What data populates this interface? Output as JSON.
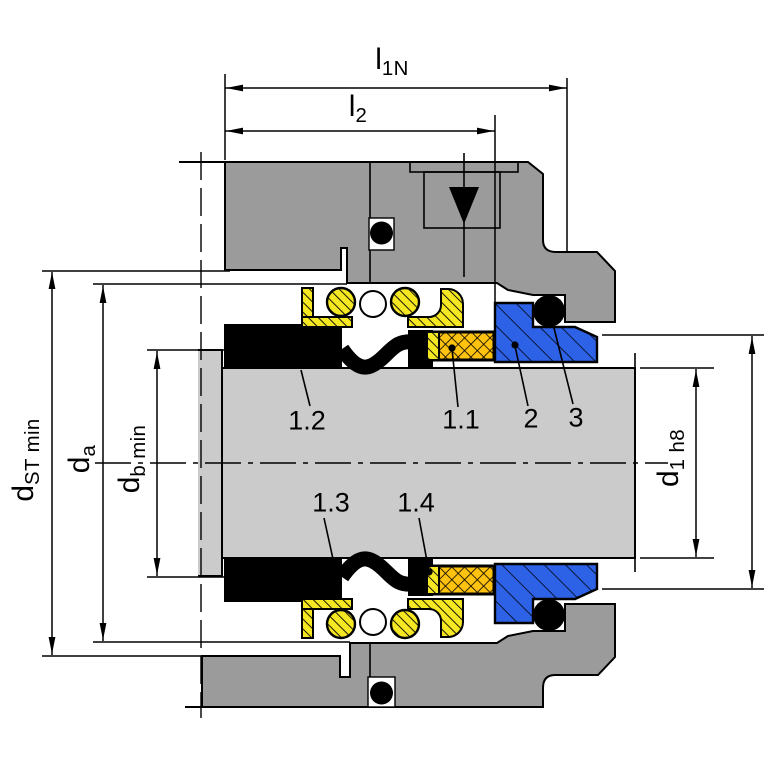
{
  "drawing": {
    "title": "mechanical-seal-cross-section",
    "dimensions": {
      "l1n": {
        "main": "l",
        "sub": "1N"
      },
      "l2": {
        "main": "l",
        "sub": "2"
      },
      "d_st_min": {
        "main": "d",
        "sub": "ST min"
      },
      "d_a": {
        "main": "d",
        "sub": "a"
      },
      "d_b_min": {
        "main": "d",
        "sub": "b min"
      },
      "d_1_h8": {
        "main": "d",
        "sub": "1 h8"
      }
    },
    "part_labels": {
      "p12": "1.2",
      "p11": "1.1",
      "p2": "2",
      "p3": "3",
      "p13": "1.3",
      "p14": "1.4"
    }
  },
  "colors": {
    "housing": "#9b9b9b",
    "shaft": "#cbcbcb",
    "spring": "#f5e722",
    "face": "#ffc20e",
    "seat": "#2e62e6",
    "line": "#000000"
  }
}
